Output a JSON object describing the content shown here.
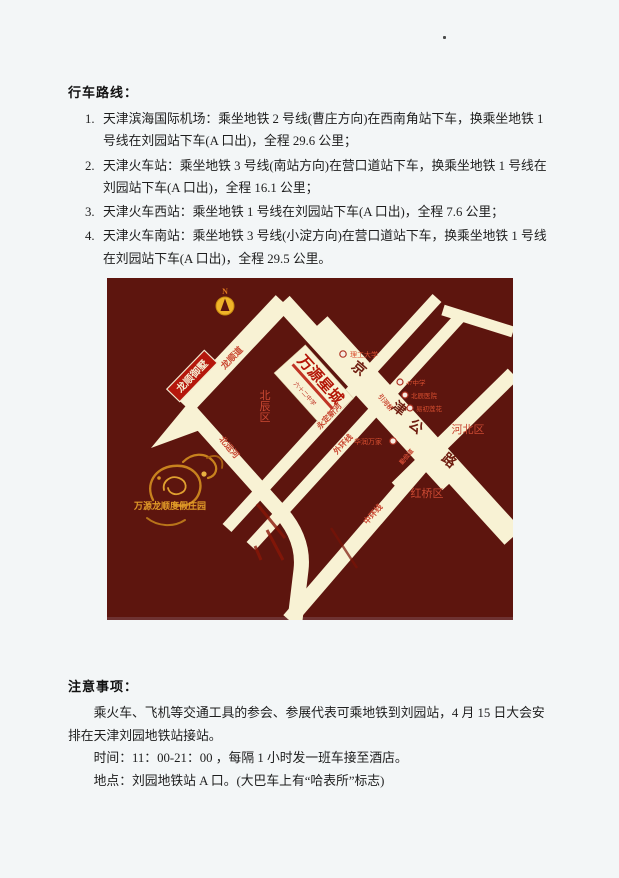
{
  "route": {
    "title": "行车路线：",
    "items": [
      {
        "num": "1.",
        "text": "天津滨海国际机场：乘坐地铁 2 号线(曹庄方向)在西南角站下车，换乘坐地铁 1 号线在刘园站下车(A 口出)，全程 29.6 公里；"
      },
      {
        "num": "2.",
        "text": "天津火车站：乘坐地铁 3 号线(南站方向)在营口道站下车，换乘坐地铁 1 号线在刘园站下车(A 口出)，全程 16.1 公里；"
      },
      {
        "num": "3.",
        "text": "天津火车西站：乘坐地铁 1 号线在刘园站下车(A 口出)，全程 7.6 公里；"
      },
      {
        "num": "4.",
        "text": "天津火车南站：乘坐地铁 3 号线(小淀方向)在营口道站下车，换乘坐地铁 1 号线在刘园站下车(A 口出)，全程 29.5 公里。"
      }
    ]
  },
  "notice": {
    "title": "注意事项：",
    "paragraphs": [
      "乘火车、飞机等交通工具的参会、参展代表可乘地铁到刘园站，4 月 15 日大会安排在天津刘园地铁站接站。",
      "时间：11：00-21：00 ，每隔 1 小时发一班车接至酒店。",
      "地点：刘园地铁站 A 口。(大巴车上有“哈表所”标志)"
    ]
  },
  "map": {
    "colors": {
      "background": "#5d150e",
      "road": "#f8f2d4",
      "label_red": "#c94832",
      "gold": "#cf8a1e"
    },
    "compass": "N",
    "project": {
      "name": "万源星城",
      "sub": "六十二中学"
    },
    "villa": "龙顺御墅",
    "resort": "万源龙顺度假庄园",
    "districts": {
      "beichen": "北辰区",
      "hongqiao": "红桥区",
      "hebei": "河北区"
    },
    "roads": {
      "longshundao": "龙顺道",
      "beiyunhe": "北运河",
      "yongdingxinhe": "永定新河",
      "waihuanxian": "外环线",
      "zhonghuanxian": "中环线",
      "yinheqiao": "引河桥",
      "qinjiandao": "勤俭道"
    },
    "highway_chars": [
      "京",
      "津",
      "公",
      "路"
    ],
    "pois": {
      "ligong": "理工大学",
      "school47": "47中学",
      "hospital": "北辰医院",
      "lotus": "易初莲花",
      "huarun": "华润万家"
    }
  }
}
